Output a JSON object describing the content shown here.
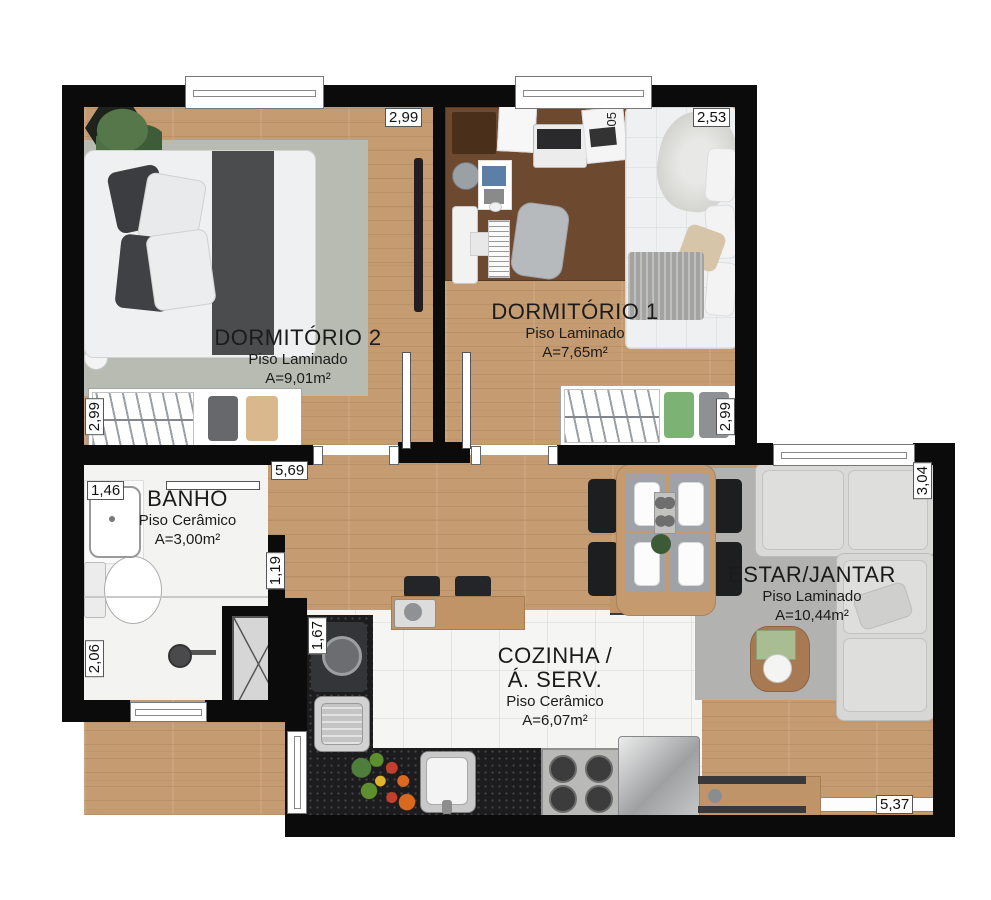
{
  "rooms": {
    "dormitorio2": {
      "name": "DORMITÓRIO 2",
      "floor": "Piso Laminado",
      "area": "A=9,01m²"
    },
    "dormitorio1": {
      "name": "DORMITÓRIO 1",
      "floor": "Piso Laminado",
      "area": "A=7,65m²"
    },
    "banho": {
      "name": "BANHO",
      "floor": "Piso Cerâmico",
      "area": "A=3,00m²"
    },
    "cozinha": {
      "name_line1": "COZINHA /",
      "name_line2": "Á. SERV.",
      "floor": "Piso Cerâmico",
      "area": "A=6,07m²"
    },
    "estar": {
      "name": "ESTAR/JANTAR",
      "floor": "Piso Laminado",
      "area": "A=10,44m²"
    }
  },
  "dimensions": {
    "dorm2_top": "2,99",
    "dorm1_top": "2,53",
    "dorm2_left": "2,99",
    "banho_top": "1,46",
    "hall_top": "5,69",
    "dorm1_right": "2,99",
    "estar_right": "3,04",
    "banho_door": "1,19",
    "banho_left": "2,06",
    "cozinha_left": "1,67",
    "bottom_right": "5,37"
  },
  "annotations": {
    "desk_magazine": "05"
  },
  "colors": {
    "wall": "#0b0b0b",
    "wood_floor": "#c59c72",
    "tile_floor": "#f5f5f3",
    "rug": "#b7bab1",
    "counter": "#1c1c1e",
    "sofa": "#d9d9d7",
    "accent_shirt_green": "#7cb274",
    "accent_shirt_beige": "#d9b88e"
  }
}
